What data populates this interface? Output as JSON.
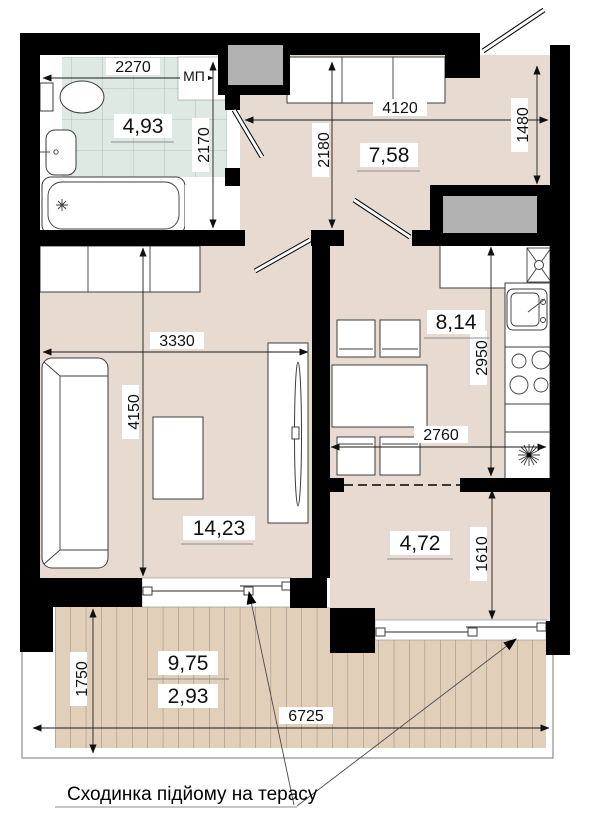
{
  "plan": {
    "annotation": "Сходинка підйому на терасу",
    "window_marker": "МП",
    "rooms": {
      "bathroom": {
        "area": "4,93",
        "width": "2270",
        "height": "2170"
      },
      "hallway": {
        "area": "7,58",
        "width": "4120",
        "height": "2180",
        "entry": "1480"
      },
      "kitchen": {
        "area": "8,14",
        "height": "2950",
        "width": "2760"
      },
      "living": {
        "area": "14,23",
        "width": "3330",
        "height": "4150"
      },
      "niche": {
        "area": "4,72",
        "height": "1610"
      },
      "terrace": {
        "area_full": "9,75",
        "area_reduced": "2,93",
        "depth": "1750",
        "width": "6725"
      }
    },
    "colors": {
      "wall": "#000000",
      "floor": "#e7dbd1",
      "deck": "#e2cfba",
      "tile": "#dfe9e4",
      "shaft": "#b2b2b2"
    }
  }
}
